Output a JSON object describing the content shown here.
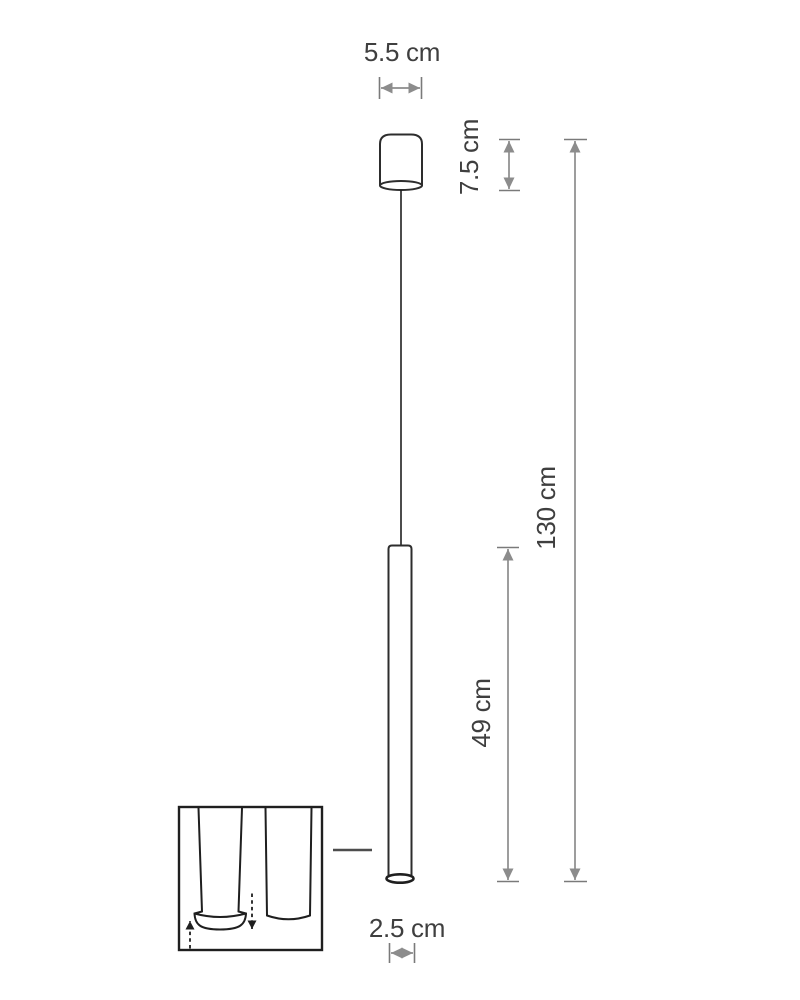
{
  "diagram": {
    "labels": {
      "canopy_width": "5.5 cm",
      "canopy_height": "7.5 cm",
      "total_height": "130 cm",
      "tube_length": "49 cm",
      "tube_diameter": "2.5 cm"
    },
    "colors": {
      "background": "#ffffff",
      "drawing_outline": "#2d2d2d",
      "measure_arrow": "#8c8c8c",
      "label_text": "#3f3f3f"
    }
  }
}
